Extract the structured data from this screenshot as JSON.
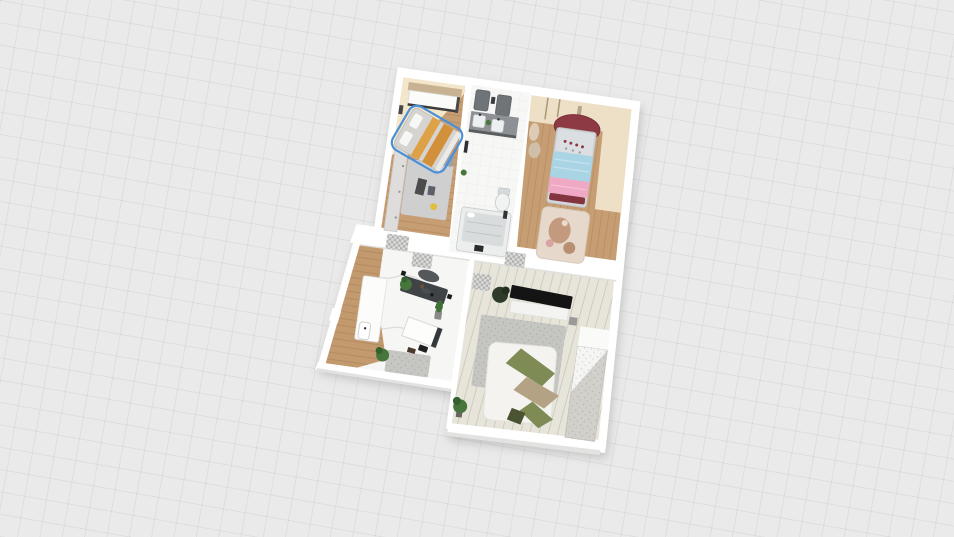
{
  "app": {
    "type": "3d-floorplan-viewer",
    "view_mode": "3d-top-down",
    "visible_text": ""
  },
  "canvas": {
    "background": "#eaeaea",
    "grid_line": "#dedede",
    "plan_rotation_deg": 8
  },
  "selection": {
    "selected_item": "double-bed",
    "room": "bedroom-main",
    "outline_color": "#4a90d9"
  },
  "colors": {
    "wall": "#ffffff",
    "wall_shade": "#e2e2e0",
    "wood_floor": "#c79e73",
    "wood_floor_hall": "#c29a6e",
    "wood_floor_light": "#e7e4da",
    "marble_floor": "#f6f6f4",
    "bath_floor": "#f7f7f6",
    "cream_floor": "#f3e6ca",
    "cream_floor_kid": "#eee0c6",
    "selection": "#4a90d9",
    "bed_gray": "#d6d4d0",
    "bed_stripe": "#dfa146",
    "bed_stripe2": "#d3903a",
    "pillow_white": "#f7f7f5",
    "wardrobe_gray": "#dedddb",
    "unit_tan": "#c8b292",
    "rug_gray": "#cfcfcf",
    "rug_living": "#c5c5c2",
    "rug_kitchen": "#c6c6c3",
    "rug_kid": "#e6d9cc",
    "rug_kid_figure": "#c49a7e",
    "canopy_red": "#8e3a44",
    "duvet_blue": "#a9d4e4",
    "blanket_pink": "#efa9c4",
    "bed_frame_gray": "#d3d6d8",
    "vanity_dark": "#8d9094",
    "mirror_dark": "#6f7478",
    "sink_white": "#edf0f0",
    "toilet_white": "#f1f3f3",
    "tub_gray": "#d9dcdd",
    "tub_rim": "#eceeee",
    "table_dark": "#3f4345",
    "chair_dark": "#54585a",
    "counter_white": "#fcfcfb",
    "desk_white": "#fdfdfc",
    "tv_black": "#141414",
    "cabinet_white": "#f3f3f1",
    "sofa_white": "#f4f3f0",
    "blanket_olive": "#7e8b55",
    "blanket_tan": "#b3a284",
    "pillow_dark_green": "#4a5332",
    "plant_green": "#47763c",
    "plant_dark": "#2f3b2a",
    "wardrobe_living": "#d2d0cb"
  },
  "rooms": [
    {
      "name": "bedroom-main",
      "floor": "wood with cream area"
    },
    {
      "name": "bathroom",
      "floor": "white tile"
    },
    {
      "name": "bedroom-kids",
      "floor": "wood with cream border"
    },
    {
      "name": "kitchen-dining",
      "floor": "white marble with wood hallway"
    },
    {
      "name": "living-room",
      "floor": "light wood planks"
    }
  ],
  "furniture": [
    {
      "room": "bedroom-main",
      "items": [
        "double-bed-selected",
        "wall-shelf-unit",
        "wardrobe",
        "rug",
        "bench",
        "plant",
        "side-table",
        "wall-lamp"
      ]
    },
    {
      "room": "bathroom",
      "items": [
        "mirror-left",
        "mirror-right",
        "double-vanity",
        "sink-left",
        "sink-right",
        "toilet",
        "bathtub",
        "plant-small",
        "towel-rail",
        "bath-mat"
      ]
    },
    {
      "room": "bedroom-kids",
      "items": [
        "canopy-bed",
        "blue-duvet",
        "pink-blanket",
        "wall-baskets",
        "pendant-cords",
        "kids-rug"
      ]
    },
    {
      "room": "kitchen-dining",
      "items": [
        "kitchen-counter",
        "counter-sink",
        "dining-table",
        "dining-chairs",
        "table-plant",
        "cactus-pot",
        "glass-desk",
        "desk-chair",
        "rug",
        "floor-plant"
      ]
    },
    {
      "room": "living-room",
      "items": [
        "tv-bench",
        "tv-cabinet",
        "dark-plant",
        "area-rug",
        "bed-sofa",
        "olive-blanket",
        "tan-blanket",
        "dark-green-pillow",
        "floor-plant",
        "tall-wardrobe"
      ]
    }
  ],
  "doors": [
    "bedroom-main-door",
    "kitchen-door",
    "kids-room-door",
    "living-room-door"
  ]
}
